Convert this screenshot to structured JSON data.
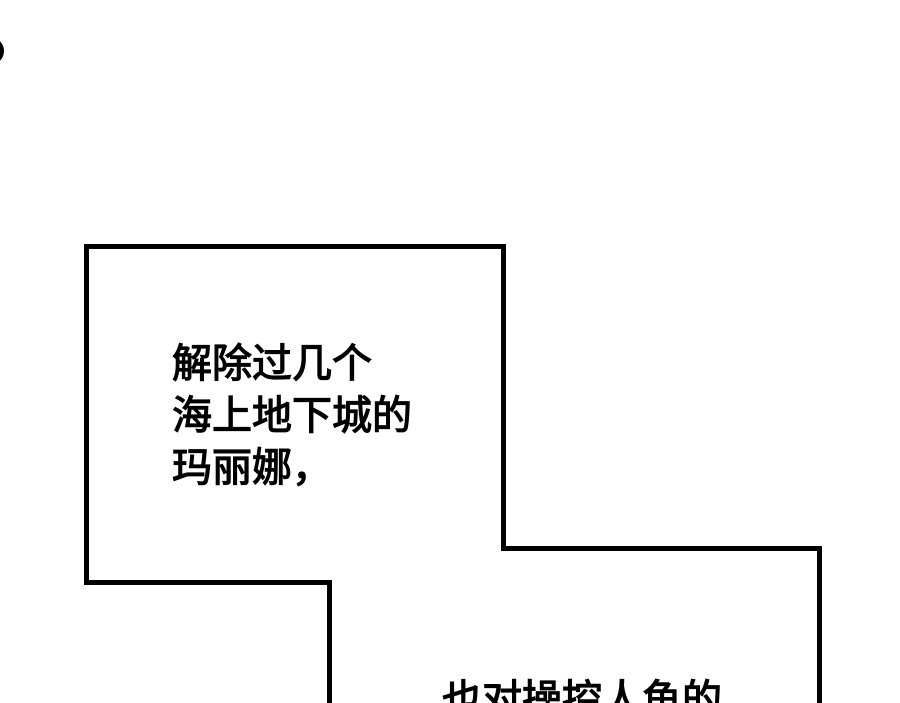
{
  "page": {
    "kind": "comic-panel-page",
    "background_color": "#ffffff",
    "ink_color": "#000000",
    "panel_fill_color": "#ffffff",
    "panel_border_color": "#000000"
  },
  "bubbles": {
    "top": {
      "lines": [
        "解除过几个",
        "海上地下城的",
        "玛丽娜，"
      ]
    },
    "bottom": {
      "lines": [
        "也对操控人鱼的"
      ]
    }
  },
  "decorations": {
    "edge_dot_icon": "partial-black-circle"
  }
}
